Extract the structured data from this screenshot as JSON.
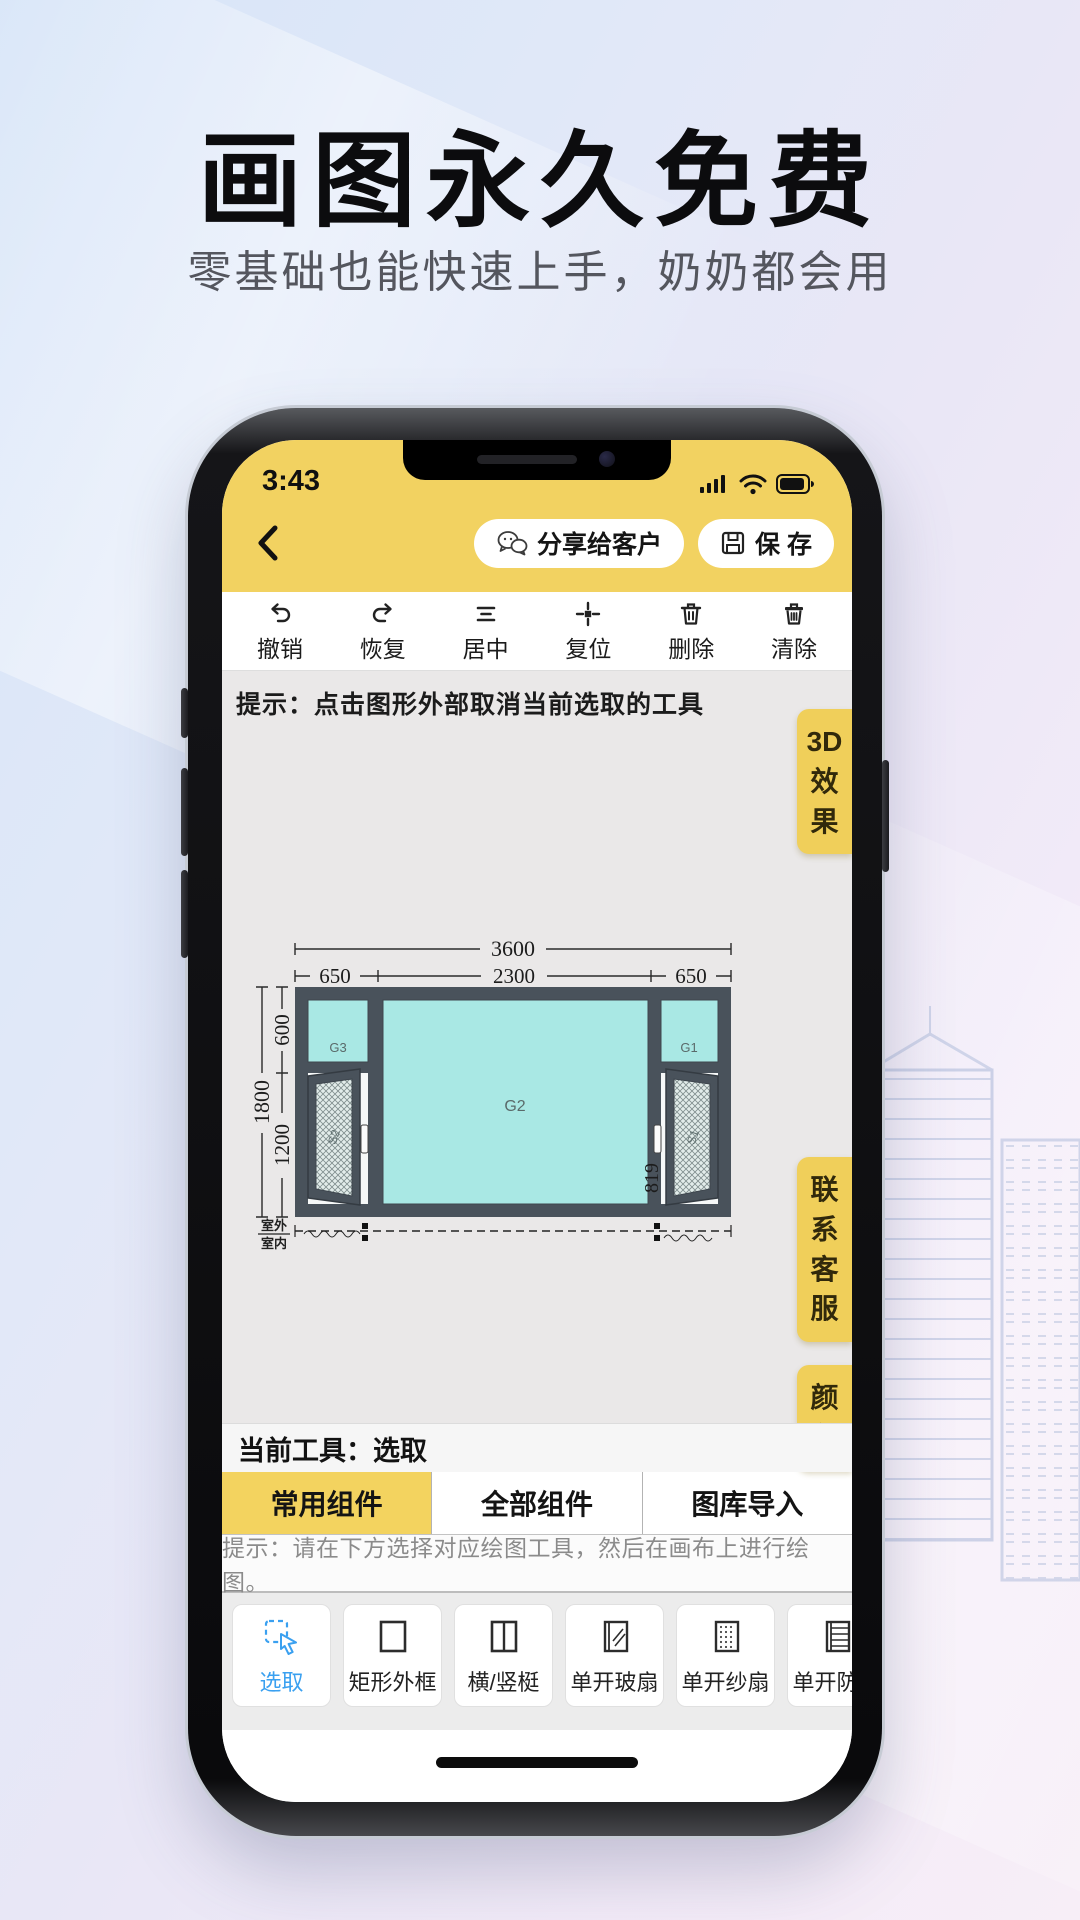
{
  "hero": {
    "title": "画图永久免费",
    "subtitle": "零基础也能快速上手，奶奶都会用"
  },
  "status_bar": {
    "time": "3:43"
  },
  "header": {
    "share_label": "分享给客户",
    "save_label": "保 存"
  },
  "toolbar": {
    "items": [
      {
        "icon": "undo-icon",
        "label": "撤销"
      },
      {
        "icon": "redo-icon",
        "label": "恢复"
      },
      {
        "icon": "align-center-icon",
        "label": "居中"
      },
      {
        "icon": "reset-icon",
        "label": "复位"
      },
      {
        "icon": "trash-icon",
        "label": "删除"
      },
      {
        "icon": "clear-icon",
        "label": "清除"
      }
    ]
  },
  "canvas": {
    "tip": "提示：点击图形外部取消当前选取的工具",
    "current_tool_label": "当前工具：选取"
  },
  "side_buttons": [
    {
      "name": "3d-effect",
      "lines": [
        "3D",
        "效",
        "果"
      ]
    },
    {
      "name": "contact-service",
      "lines": [
        "联",
        "系",
        "客",
        "服"
      ]
    },
    {
      "name": "color",
      "lines": [
        "颜",
        "色"
      ]
    }
  ],
  "diagram": {
    "total_width": "3600",
    "segment_widths": [
      "650",
      "2300",
      "650"
    ],
    "total_height": "1800",
    "segment_heights": [
      "600",
      "1200"
    ],
    "sash_dim": "819",
    "pane_labels": {
      "left": "G3",
      "center": "G2",
      "right": "G1"
    },
    "sash_labels": {
      "left": "S2",
      "right": "S1"
    },
    "outdoor_label": "室外",
    "indoor_label": "室内"
  },
  "component_tabs": [
    {
      "label": "常用组件",
      "active": true
    },
    {
      "label": "全部组件",
      "active": false
    },
    {
      "label": "图库导入",
      "active": false
    }
  ],
  "tools_tip": "提示：请在下方选择对应绘图工具，然后在画布上进行绘图。",
  "tools": [
    {
      "icon": "select-cursor-icon",
      "label": "选取",
      "active": true
    },
    {
      "icon": "rect-frame-icon",
      "label": "矩形外框",
      "active": false
    },
    {
      "icon": "mullion-icon",
      "label": "横/竖梃",
      "active": false
    },
    {
      "icon": "glass-sash-icon",
      "label": "单开玻扇",
      "active": false
    },
    {
      "icon": "screen-sash-icon",
      "label": "单开纱扇",
      "active": false
    },
    {
      "icon": "security-sash-icon",
      "label": "单开防盗",
      "active": false
    }
  ],
  "colors": {
    "accent_yellow": "#f2d261",
    "accent_blue": "#3aa0f0",
    "glass_cyan": "#a9e8e4",
    "frame_dark": "#49525b"
  }
}
